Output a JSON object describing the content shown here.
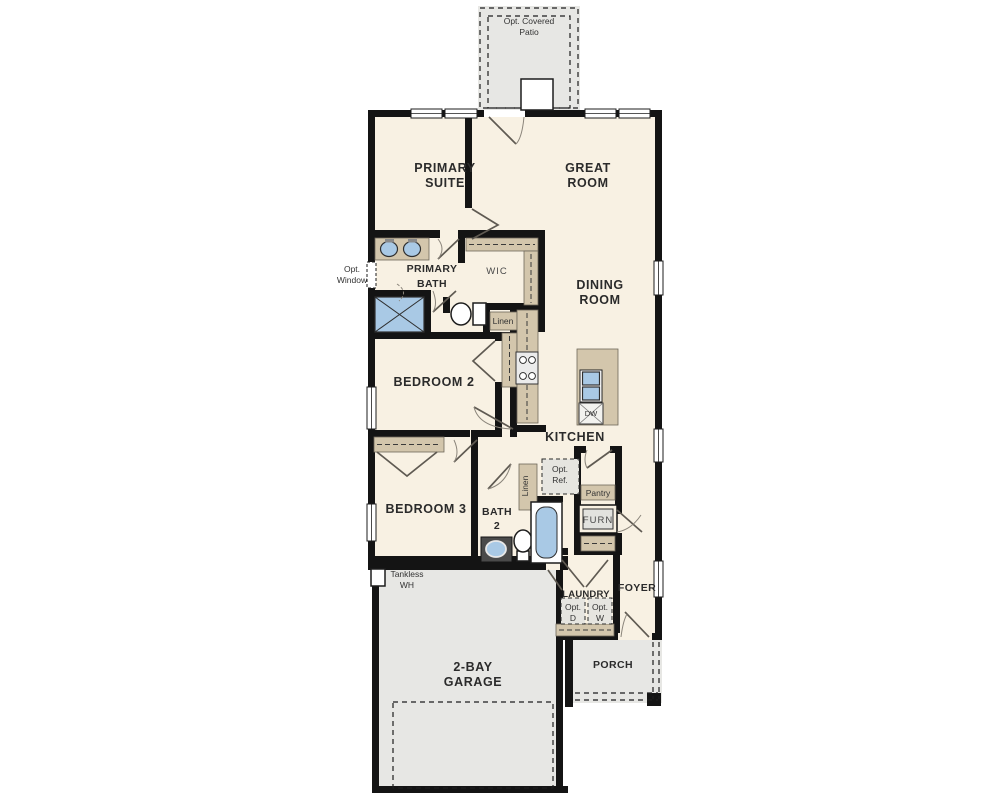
{
  "plan": {
    "type": "single-story floor plan",
    "colors": {
      "wall": "#141414",
      "floor": "#f8f1e3",
      "garage_patio_porch": "#e7e7e4",
      "cabinet_tan": "#d3c6ac",
      "fixture_blue": "#a9c9e5"
    },
    "rooms": [
      "Opt. Covered Patio",
      "Primary Suite",
      "Great Room",
      "Primary Bath",
      "WIC",
      "Dining Room",
      "Bedroom 2",
      "Kitchen",
      "Bedroom 3",
      "Bath 2",
      "Laundry",
      "Foyer",
      "2-Bay Garage",
      "Porch",
      "Pantry"
    ]
  },
  "labels": {
    "patio_l1": "Opt. Covered",
    "patio_l2": "Patio",
    "primary_suite_l1": "PRIMARY",
    "primary_suite_l2": "SUITE",
    "great_room_l1": "GREAT",
    "great_room_l2": "ROOM",
    "primary_bath_l1": "PRIMARY",
    "primary_bath_l2": "BATH",
    "wic": "WIC",
    "opt_window_l1": "Opt.",
    "opt_window_l2": "Window",
    "linen_primary": "Linen",
    "dining_l1": "DINING",
    "dining_l2": "ROOM",
    "bedroom2": "BEDROOM 2",
    "kitchen": "KITCHEN",
    "dw": "DW",
    "bedroom3": "BEDROOM 3",
    "bath2_l1": "BATH",
    "bath2_l2": "2",
    "linen_bath2": "Linen",
    "opt_ref_l1": "Opt.",
    "opt_ref_l2": "Ref.",
    "pantry": "Pantry",
    "furn": "FURN",
    "tankless_l1": "Tankless",
    "tankless_l2": "WH",
    "laundry": "LAUNDRY",
    "opt_d_l1": "Opt.",
    "opt_d_l2": "D",
    "opt_w_l1": "Opt.",
    "opt_w_l2": "W",
    "foyer": "FOYER",
    "garage_l1": "2-BAY",
    "garage_l2": "GARAGE",
    "porch": "PORCH"
  }
}
